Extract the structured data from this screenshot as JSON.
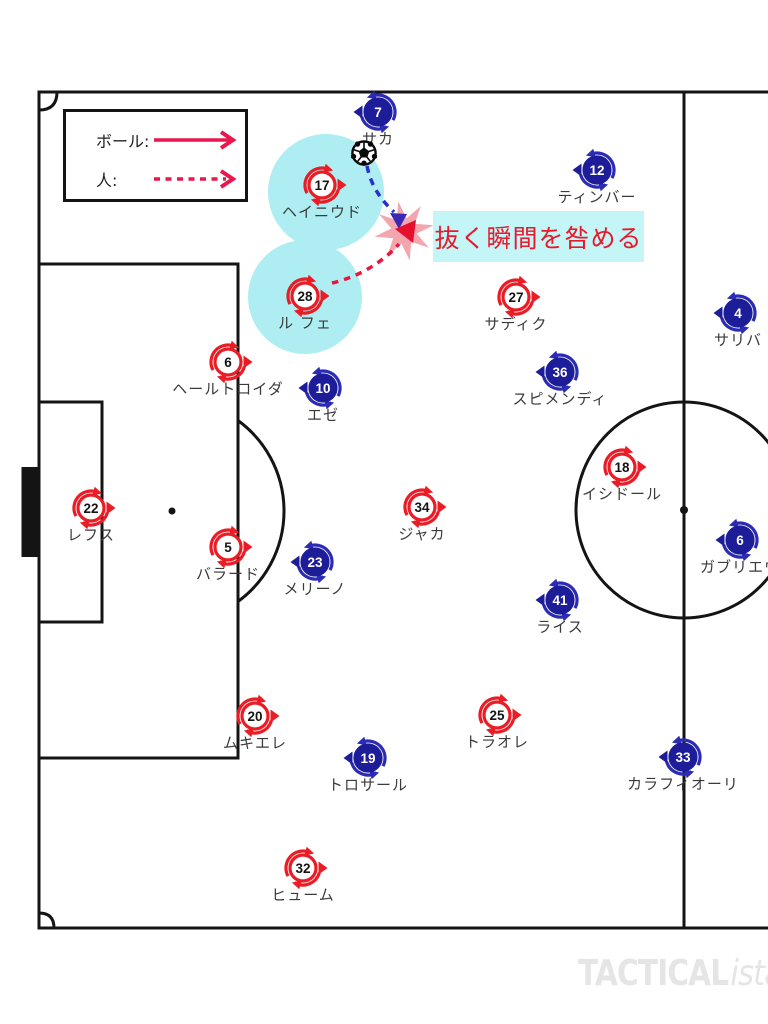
{
  "annotation": {
    "text": "抜く瞬間を咎める",
    "bg_color": "#c4f5f7",
    "text_color": "#e8192c"
  },
  "legend": {
    "ball_label": "ボール:",
    "person_label": "人:",
    "arrow_color": "#e8174e"
  },
  "watermark": {
    "bold": "TACTICAL",
    "italic": "ista"
  },
  "colors": {
    "pitch_line": "#141414",
    "highlight": "#aeeef2",
    "burst": "#f4a6ae",
    "ball_path_blue": "#2630cf",
    "ball_path_head": "#3a28b4",
    "run_path_red": "#e8163c",
    "label_text": "#3a3a3a"
  },
  "teams": {
    "red": {
      "circle_fill": "#ffffff",
      "color": "#ea1c25",
      "arc_color": "#ea1c25",
      "number_color": "#141414",
      "facing": "right"
    },
    "blue": {
      "circle_fill": "#1d1d99",
      "color": "#1d1d99",
      "arc_color": "#2b2bb5",
      "number_color": "#ffffff",
      "facing": "left"
    }
  },
  "highlights": [
    {
      "x": 326,
      "y": 192,
      "r": 58
    },
    {
      "x": 305,
      "y": 297,
      "r": 57
    }
  ],
  "players": [
    {
      "team": "blue",
      "number": "7",
      "name": "サカ",
      "x": 378,
      "y": 112
    },
    {
      "team": "blue",
      "number": "12",
      "name": "ティンバー",
      "x": 597,
      "y": 170
    },
    {
      "team": "red",
      "number": "17",
      "name": "ヘイニウド",
      "x": 322,
      "y": 185,
      "highlight": true
    },
    {
      "team": "red",
      "number": "28",
      "name": "ル フェ",
      "x": 305,
      "y": 296,
      "highlight": true
    },
    {
      "team": "red",
      "number": "27",
      "name": "サディク",
      "x": 516,
      "y": 297
    },
    {
      "team": "blue",
      "number": "4",
      "name": "サリバ",
      "x": 738,
      "y": 313
    },
    {
      "team": "red",
      "number": "6",
      "name": "ヘールトロイダ",
      "x": 228,
      "y": 362
    },
    {
      "team": "blue",
      "number": "36",
      "name": "スピメンディ",
      "x": 560,
      "y": 372
    },
    {
      "team": "blue",
      "number": "10",
      "name": "エゼ",
      "x": 323,
      "y": 388
    },
    {
      "team": "red",
      "number": "18",
      "name": "イシドール",
      "x": 622,
      "y": 467
    },
    {
      "team": "red",
      "number": "22",
      "name": "レフス",
      "x": 91,
      "y": 508
    },
    {
      "team": "red",
      "number": "34",
      "name": "ジャカ",
      "x": 422,
      "y": 507
    },
    {
      "team": "blue",
      "number": "6",
      "name": "ガブリエウ",
      "x": 740,
      "y": 540
    },
    {
      "team": "red",
      "number": "5",
      "name": "バラード",
      "x": 228,
      "y": 547
    },
    {
      "team": "blue",
      "number": "23",
      "name": "メリーノ",
      "x": 315,
      "y": 562
    },
    {
      "team": "blue",
      "number": "41",
      "name": "ライス",
      "x": 560,
      "y": 600
    },
    {
      "team": "red",
      "number": "20",
      "name": "ムキエレ",
      "x": 255,
      "y": 716
    },
    {
      "team": "red",
      "number": "25",
      "name": "トラオレ",
      "x": 497,
      "y": 715
    },
    {
      "team": "blue",
      "number": "19",
      "name": "トロサール",
      "x": 368,
      "y": 758
    },
    {
      "team": "blue",
      "number": "33",
      "name": "カラフィオーリ",
      "x": 683,
      "y": 757
    },
    {
      "team": "red",
      "number": "32",
      "name": "ヒューム",
      "x": 303,
      "y": 868
    }
  ]
}
